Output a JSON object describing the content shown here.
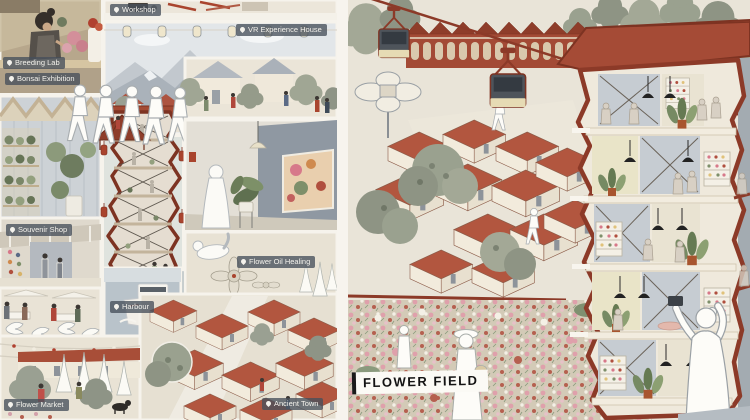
{
  "artwork": {
    "kind": "architectural illustration collage",
    "left_panel": "programme vignettes",
    "right_panel": "flower field and tower perspective"
  },
  "labels": {
    "breeding_lab": "Breeding Lab",
    "workshop": "Workshop",
    "vr_experience_house": "VR Experience House",
    "bonsai_exhibition": "Bonsai Exhibition",
    "souvenir_shop": "Souvenir Shop",
    "flower_oil_healing": "Flower Oil Healing",
    "harbour": "Harbour",
    "flower_market": "Flower Market",
    "ancient_town": "Ancient Town",
    "flower_field": "FLOWER FIELD"
  },
  "icons": {
    "location_pin": "map-pin"
  },
  "palette": {
    "canvas_bg": "#efe9dd",
    "gutter_white": "#f7f4ee",
    "terracotta_roof": "#b2563f",
    "outline_red_brown": "#8c3a28",
    "tree_green_gray": "#9aa18f",
    "slate_wall": "#8f98a2",
    "label_chip_bg": "rgba(70,80,91,0.78)",
    "label_text": "#f4f2ec",
    "flower_pink": "#dfa0ab",
    "flower_red": "#b5604f",
    "cream_floor": "#efe9dc",
    "cable_car_body": "#4e545b",
    "cable_car_band": "#e6dbb4"
  }
}
